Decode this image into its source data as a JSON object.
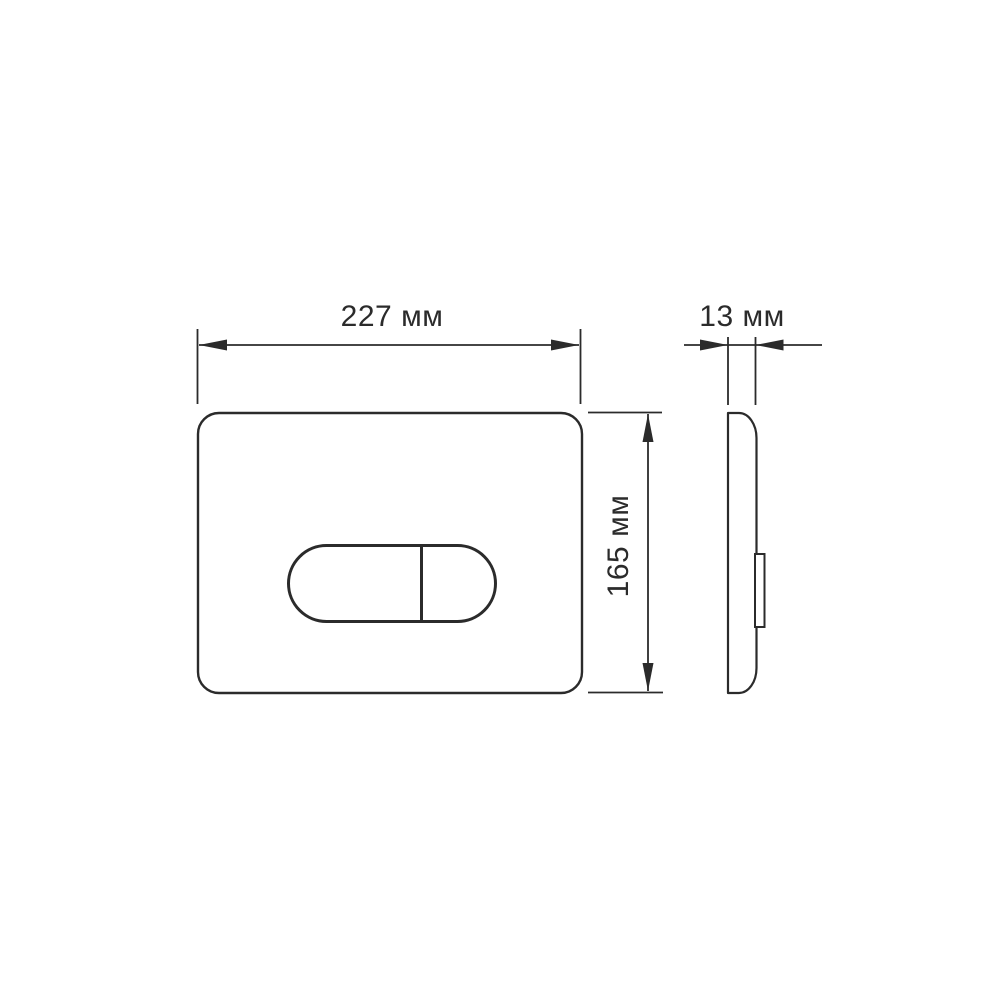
{
  "drawing": {
    "type": "technical-dimension-drawing",
    "views": [
      "front",
      "side"
    ],
    "line_color": "#2b2b2b",
    "background_color": "#ffffff",
    "dimensions": {
      "width": {
        "value": 227,
        "unit": "мм",
        "label": "227 мм"
      },
      "height": {
        "value": 165,
        "unit": "мм",
        "label": "165 мм"
      },
      "depth": {
        "value": 13,
        "unit": "мм",
        "label": "13 мм"
      }
    }
  }
}
